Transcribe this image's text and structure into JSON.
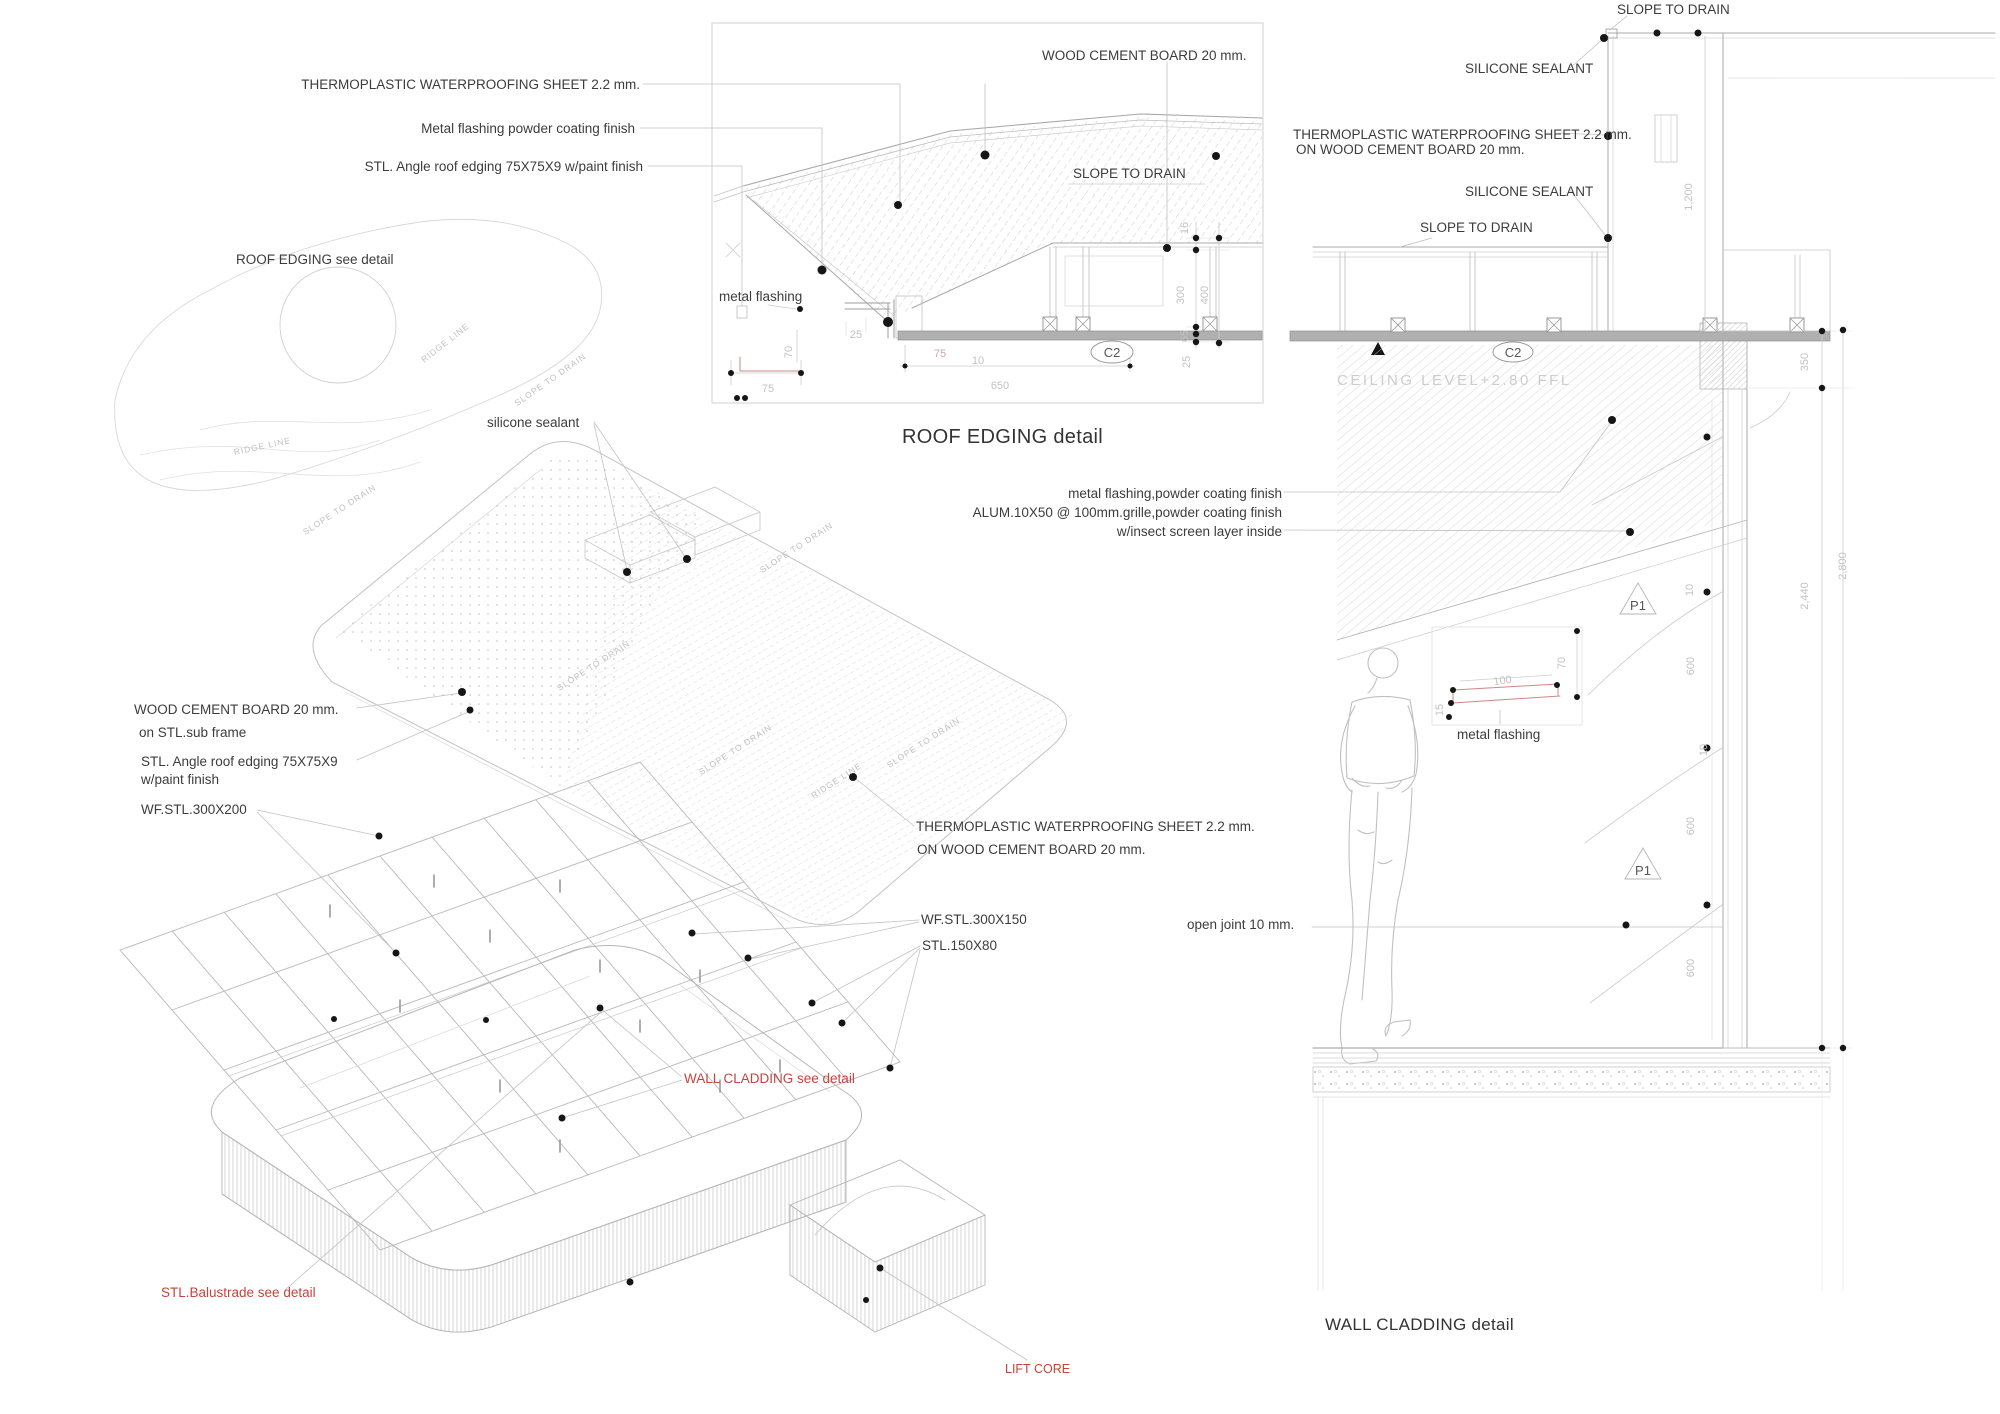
{
  "colors": {
    "accent_red": "#c5443c",
    "red_line": "#cf8781",
    "dim_gray": "#c2c2c2",
    "line_gray": "#b5b5b5",
    "text_dark": "#3c3c3c",
    "strip_gray": "#b0b0b0"
  },
  "roof_edging": {
    "title": "ROOF EDGING detail",
    "callouts": {
      "thermoplastic": "THERMOPLASTIC WATERPROOFING SHEET 2.2 mm.",
      "metal_flashing_powder": "Metal flashing powder coating finish",
      "stl_angle": "STL. Angle roof edging 75X75X9 w/paint finish",
      "wood_cement_board": "WOOD CEMENT BOARD 20 mm.",
      "slope_to_drain": "SLOPE TO DRAIN",
      "metal_flashing": "metal flashing",
      "c2": "C2"
    },
    "dims": {
      "d70": "70",
      "d25": "25",
      "d75": "75",
      "d10": "10",
      "d650": "650",
      "d75b": "75",
      "d16": "16",
      "d300": "300",
      "d400": "400",
      "d65": "65",
      "d25b": "25"
    }
  },
  "axonometric": {
    "callouts": {
      "roof_edging_see_detail": "ROOF EDGING see detail",
      "silicone_sealant": "silicone sealant",
      "wood_cement_board": "WOOD CEMENT BOARD 20 mm.",
      "on_stl_sub_frame": "on STL.sub frame",
      "stl_angle_line1": "STL. Angle roof edging 75X75X9",
      "stl_angle_line2": "w/paint finish",
      "wf_stl_300x200": "WF.STL.300X200",
      "thermoplastic_line1": "THERMOPLASTIC WATERPROOFING SHEET 2.2 mm.",
      "thermoplastic_line2": "ON WOOD CEMENT BOARD 20 mm.",
      "wf_stl_300x150": "WF.STL.300X150",
      "stl_150x80": "STL.150X80",
      "wall_cladding_see_detail": "WALL CLADDING see detail",
      "stl_balustrade_see_detail": "STL.Balustrade see detail",
      "lift_core": "LIFT CORE"
    },
    "surface_labels": {
      "ridge_line": "RIDGE LINE",
      "slope_to_drain": "SLOPE TO DRAIN"
    }
  },
  "wall_cladding": {
    "title": "WALL CLADDING detail",
    "callouts": {
      "slope_to_drain_top": "SLOPE TO DRAIN",
      "silicone_sealant_upper": "SILICONE SEALANT",
      "thermoplastic_line1": "THERMOPLASTIC WATERPROOFING SHEET 2.2 mm.",
      "thermoplastic_line2": "ON WOOD CEMENT BOARD 20 mm.",
      "silicone_sealant_lower": "SILICONE SEALANT",
      "slope_to_drain": "SLOPE TO DRAIN",
      "ceiling_level": "CEILING LEVEL+2.80 FFL",
      "c2": "C2",
      "metal_flashing_powder": "metal flashing,powder coating finish",
      "alum_grille_line1": "ALUM.10X50 @ 100mm.grille,powder coating finish",
      "alum_grille_line2": "w/insect screen layer inside",
      "metal_flashing": "metal flashing",
      "open_joint": "open joint 10 mm.",
      "p1": "P1"
    },
    "dims": {
      "d1200": "1,200",
      "d350": "350",
      "d2440": "2,440",
      "d2800": "2,800",
      "d600": "600",
      "d10": "10",
      "d100": "100",
      "d70": "70",
      "d15": "15"
    }
  }
}
